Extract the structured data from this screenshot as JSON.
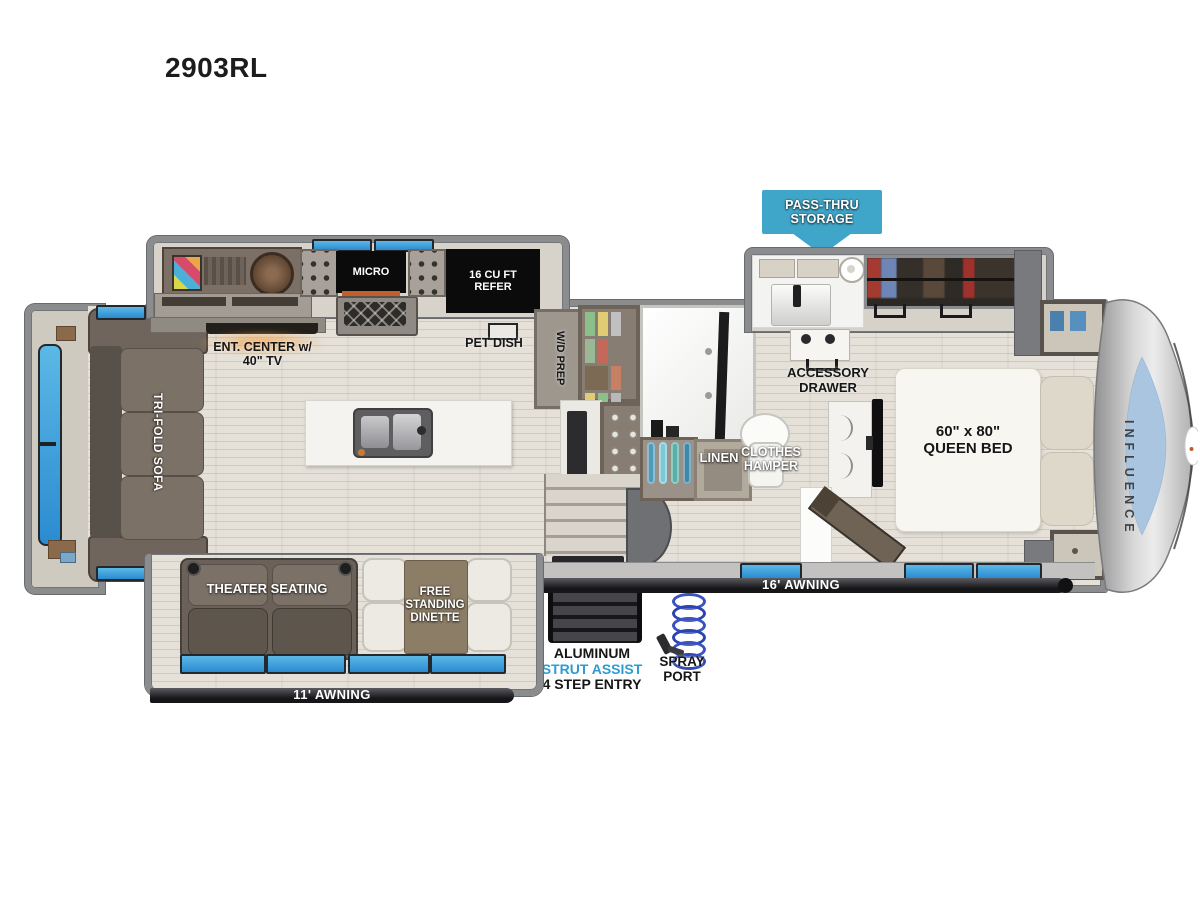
{
  "title": "2903RL",
  "labels": {
    "pass_thru": "PASS-THRU\nSTORAGE",
    "micro": "MICRO",
    "refer": "16 CU FT\nREFER",
    "pet_dish": "PET DISH",
    "ent_center": "ENT. CENTER w/\n40\" TV",
    "wd_prep": "W/D PREP",
    "tri_fold_sofa": "TRI-FOLD SOFA",
    "accessory_drawer": "ACCESSORY\nDRAWER",
    "linen": "LINEN",
    "clothes_hamper": "CLOTHES\nHAMPER",
    "queen_bed": "60\" x 80\"\nQUEEN BED",
    "brand": "INFLUENCE",
    "theater_seating": "THEATER SEATING",
    "dinette": "FREE\nSTANDING\nDINETTE",
    "awning_16": "16' AWNING",
    "awning_11": "11' AWNING",
    "entry_line1": "ALUMINUM",
    "entry_line2": "STRUT ASSIST",
    "entry_line3": "4 STEP ENTRY",
    "spray_port": "SPRAY\nPORT"
  },
  "colors": {
    "callout_teal": "#3FA6C9",
    "strut_assist_blue": "#2D9CD4",
    "window_blue": "#2E93D2",
    "awning_bar": "#1E1E20",
    "wall_gray": "#8B8C8E",
    "floor_beige": "#E4E0D8",
    "appliance_black": "#0B0B0B",
    "sofa_brown": "#6E635A",
    "dinette_brown": "#8C7D66",
    "tv_glow_orange": "#E09A50",
    "front_cap_blue": "#A9C5DF"
  }
}
